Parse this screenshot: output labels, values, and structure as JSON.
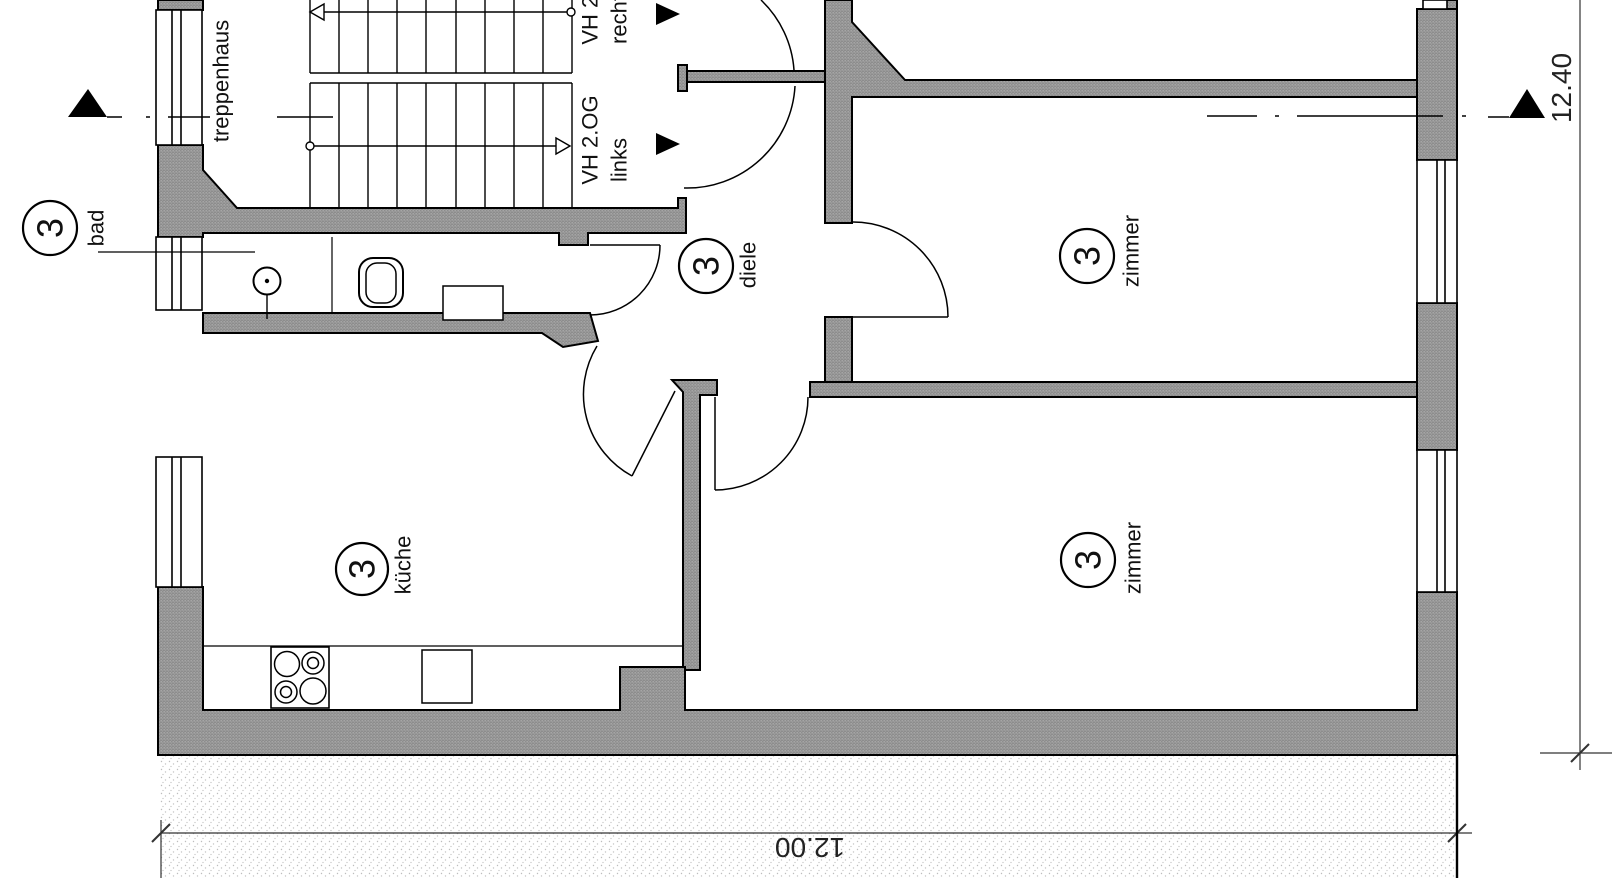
{
  "plan": {
    "stairwell_label": "treppenhaus",
    "entries": {
      "right": {
        "line1": "VH 2.OG",
        "line2": "rechts"
      },
      "left": {
        "line1": "VH 2.OG",
        "line2": "links"
      }
    },
    "rooms": [
      {
        "number": "3",
        "name": "bad"
      },
      {
        "number": "3",
        "name": "diele"
      },
      {
        "number": "3",
        "name": "zimmer"
      },
      {
        "number": "3",
        "name": "küche"
      },
      {
        "number": "3",
        "name": "zimmer"
      }
    ],
    "dimensions": {
      "bottom_width": "12.00",
      "right_height": "12.40"
    },
    "colors": {
      "wall_fill": "#9a9a9a",
      "line": "#000000",
      "ground_dot": "#bdbdbd"
    }
  }
}
